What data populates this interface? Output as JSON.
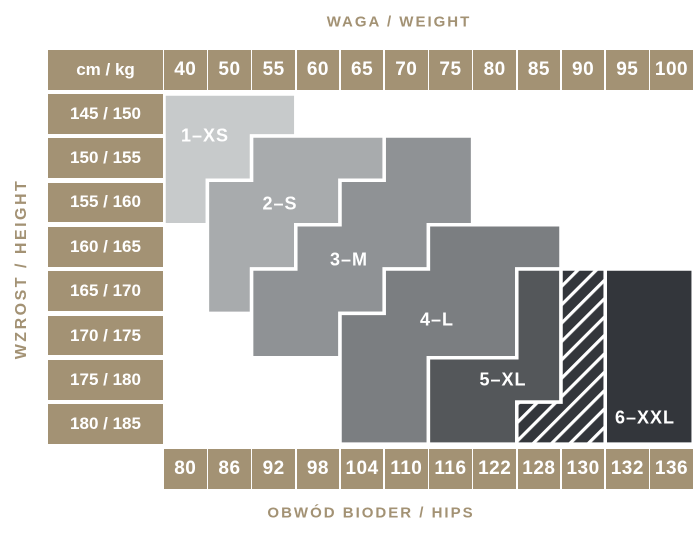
{
  "labels": {
    "top": "WAGA / WEIGHT",
    "left": "WZROST / HEIGHT",
    "bottom": "OBWÓD BIODER / HIPS",
    "corner": "cm / kg"
  },
  "weights": [
    "40",
    "50",
    "55",
    "60",
    "65",
    "70",
    "75",
    "80",
    "85",
    "90",
    "95",
    "100"
  ],
  "heights": [
    "145 / 150",
    "150 / 155",
    "155 / 160",
    "160 / 165",
    "165 / 170",
    "170 / 175",
    "175 / 180",
    "180 / 185"
  ],
  "hips": [
    "80",
    "86",
    "92",
    "98",
    "104",
    "110",
    "116",
    "122",
    "128",
    "130",
    "132",
    "136"
  ],
  "colors": {
    "tan": "#a39274",
    "cell_text": "#ffffff",
    "region_border": "#ffffff",
    "xs": "#c7cacb",
    "s": "#a8abad",
    "m": "#8f9295",
    "l": "#7b7e81",
    "xl": "#54575a",
    "xxl": "#33363b"
  },
  "sizes": [
    {
      "key": "1-xs",
      "label": "1–XS",
      "color_key": "xs",
      "hatched": false,
      "label_x": 205,
      "label_y": 136,
      "rows": [
        {
          "row": 0,
          "from": 0,
          "to": 2
        },
        {
          "row": 1,
          "from": 0,
          "to": 1
        },
        {
          "row": 2,
          "from": 0,
          "to": 0
        }
      ]
    },
    {
      "key": "2-s",
      "label": "2–S",
      "color_key": "s",
      "hatched": false,
      "label_x": 280,
      "label_y": 204,
      "rows": [
        {
          "row": 1,
          "from": 2,
          "to": 4
        },
        {
          "row": 2,
          "from": 1,
          "to": 3
        },
        {
          "row": 3,
          "from": 1,
          "to": 2
        },
        {
          "row": 4,
          "from": 1,
          "to": 1
        }
      ]
    },
    {
      "key": "3-m",
      "label": "3–M",
      "color_key": "m",
      "hatched": false,
      "label_x": 349,
      "label_y": 260,
      "rows": [
        {
          "row": 1,
          "from": 5,
          "to": 6
        },
        {
          "row": 2,
          "from": 4,
          "to": 6
        },
        {
          "row": 3,
          "from": 3,
          "to": 5
        },
        {
          "row": 4,
          "from": 2,
          "to": 4
        },
        {
          "row": 5,
          "from": 2,
          "to": 3
        }
      ]
    },
    {
      "key": "4-l",
      "label": "4–L",
      "color_key": "l",
      "hatched": false,
      "label_x": 437,
      "label_y": 320,
      "rows": [
        {
          "row": 3,
          "from": 6,
          "to": 8
        },
        {
          "row": 4,
          "from": 5,
          "to": 7
        },
        {
          "row": 5,
          "from": 4,
          "to": 7
        },
        {
          "row": 6,
          "from": 4,
          "to": 5
        },
        {
          "row": 7,
          "from": 4,
          "to": 5
        }
      ]
    },
    {
      "key": "5-xl",
      "label": "5–XL",
      "color_key": "xl",
      "hatched": false,
      "label_x": 503,
      "label_y": 380,
      "rows": [
        {
          "row": 4,
          "from": 8,
          "to": 8
        },
        {
          "row": 5,
          "from": 8,
          "to": 8
        },
        {
          "row": 6,
          "from": 6,
          "to": 8
        },
        {
          "row": 7,
          "from": 6,
          "to": 7
        }
      ]
    },
    {
      "key": "6-xxl",
      "label": "6–XXL",
      "color_key": "xxl",
      "hatched": false,
      "label_x": 645,
      "label_y": 418,
      "rows": [
        {
          "row": 4,
          "from": 10,
          "to": 11
        },
        {
          "row": 5,
          "from": 10,
          "to": 11
        },
        {
          "row": 6,
          "from": 10,
          "to": 11
        },
        {
          "row": 7,
          "from": 10,
          "to": 11
        }
      ]
    },
    {
      "key": "transition-hatch",
      "label": "",
      "color_key": "xxl",
      "hatched": true,
      "label_x": 0,
      "label_y": 0,
      "rows": [
        {
          "row": 4,
          "from": 9,
          "to": 9
        },
        {
          "row": 5,
          "from": 9,
          "to": 9
        },
        {
          "row": 6,
          "from": 9,
          "to": 9
        },
        {
          "row": 7,
          "from": 8,
          "to": 9
        }
      ]
    }
  ],
  "chart_data": {
    "type": "heatmap",
    "title": "Size chart (tights): weight × height → size, with hips circumference",
    "x_axis": {
      "label": "WAGA / WEIGHT",
      "unit": "kg",
      "ticks": [
        40,
        50,
        55,
        60,
        65,
        70,
        75,
        80,
        85,
        90,
        95,
        100
      ],
      "position": "top"
    },
    "y_axis": {
      "label": "WZROST / HEIGHT",
      "unit": "cm",
      "ticks": [
        "145 / 150",
        "150 / 155",
        "155 / 160",
        "160 / 165",
        "165 / 170",
        "170 / 175",
        "175 / 180",
        "180 / 185"
      ],
      "position": "left"
    },
    "x2_axis": {
      "label": "OBWÓD BIODER / HIPS",
      "unit": "cm",
      "ticks": [
        80,
        86,
        92,
        98,
        104,
        110,
        116,
        122,
        128,
        130,
        132,
        136
      ],
      "position": "bottom"
    },
    "corner_cell": "cm / kg",
    "legend": [
      "1–XS",
      "2–S",
      "3–M",
      "4–L",
      "5–XL",
      "6–XXL",
      "HATCH"
    ],
    "hatch_note": "HATCH = white diagonal-striped transition band between 5–XL and 6–XXL",
    "grid": false,
    "cells": [
      [
        "1–XS",
        "1–XS",
        "1–XS",
        "",
        "",
        "",
        "",
        "",
        "",
        "",
        "",
        ""
      ],
      [
        "1–XS",
        "1–XS",
        "2–S",
        "2–S",
        "2–S",
        "3–M",
        "3–M",
        "",
        "",
        "",
        "",
        ""
      ],
      [
        "1–XS",
        "2–S",
        "2–S",
        "2–S",
        "3–M",
        "3–M",
        "3–M",
        "",
        "",
        "",
        "",
        ""
      ],
      [
        "",
        "2–S",
        "2–S",
        "3–M",
        "3–M",
        "3–M",
        "4–L",
        "4–L",
        "4–L",
        "",
        "",
        ""
      ],
      [
        "",
        "2–S",
        "3–M",
        "3–M",
        "3–M",
        "4–L",
        "4–L",
        "4–L",
        "5–XL",
        "HATCH",
        "6–XXL",
        "6–XXL"
      ],
      [
        "",
        "",
        "3–M",
        "3–M",
        "4–L",
        "4–L",
        "4–L",
        "4–L",
        "5–XL",
        "HATCH",
        "6–XXL",
        "6–XXL"
      ],
      [
        "",
        "",
        "",
        "",
        "4–L",
        "4–L",
        "5–XL",
        "5–XL",
        "5–XL",
        "HATCH",
        "6–XXL",
        "6–XXL"
      ],
      [
        "",
        "",
        "",
        "",
        "4–L",
        "4–L",
        "5–XL",
        "5–XL",
        "HATCH",
        "HATCH",
        "6–XXL",
        "6–XXL"
      ]
    ]
  }
}
